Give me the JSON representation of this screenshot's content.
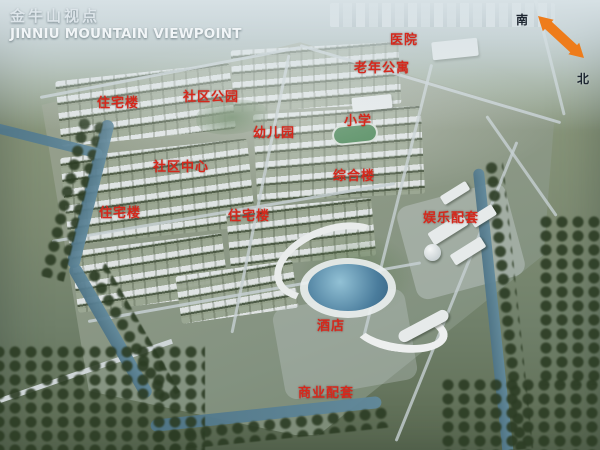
{
  "header": {
    "title_zh": "金牛山视点",
    "title_en": "JINNIU MOUNTAIN VIEWPOINT"
  },
  "compass": {
    "south": "南",
    "north": "北",
    "arrow_color": "#ee7c1b"
  },
  "map": {
    "label_color": "#d5281c",
    "labels": [
      {
        "id": "hospital",
        "text": "医院",
        "x": 390,
        "y": 29
      },
      {
        "id": "senior-apartments",
        "text": "老年公寓",
        "x": 354,
        "y": 57
      },
      {
        "id": "community-park",
        "text": "社区公园",
        "x": 183,
        "y": 86
      },
      {
        "id": "residential-1",
        "text": "住宅楼",
        "x": 97,
        "y": 92
      },
      {
        "id": "primary-school",
        "text": "小学",
        "x": 344,
        "y": 110
      },
      {
        "id": "kindergarten",
        "text": "幼儿园",
        "x": 253,
        "y": 122
      },
      {
        "id": "community-center",
        "text": "社区中心",
        "x": 153,
        "y": 156
      },
      {
        "id": "mixed-use-building",
        "text": "综合楼",
        "x": 333,
        "y": 165
      },
      {
        "id": "residential-2",
        "text": "住宅楼",
        "x": 99,
        "y": 202
      },
      {
        "id": "residential-3",
        "text": "住宅楼",
        "x": 228,
        "y": 205
      },
      {
        "id": "entertainment-suites",
        "text": "娱乐配套",
        "x": 423,
        "y": 207
      },
      {
        "id": "hotel",
        "text": "酒店",
        "x": 317,
        "y": 315
      },
      {
        "id": "commercial-facilities",
        "text": "商业配套",
        "x": 298,
        "y": 382
      }
    ]
  }
}
